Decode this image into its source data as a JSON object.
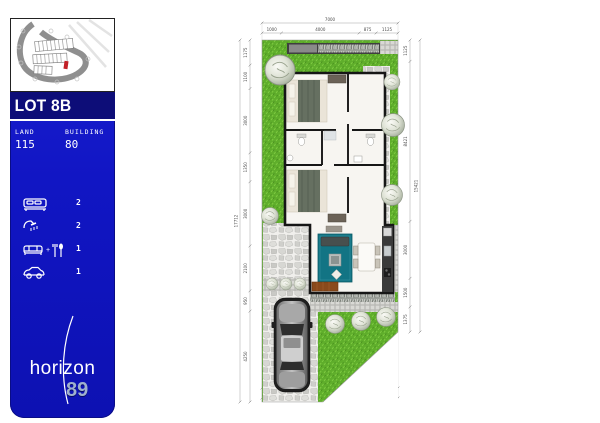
{
  "sidebar": {
    "lot_label": "LOT 8B",
    "land_label": "LAND",
    "land_value": "115",
    "building_label": "BUILDING",
    "building_value": "80",
    "amenities": [
      {
        "name": "bedrooms",
        "icon": "bed-icon",
        "count": "2"
      },
      {
        "name": "bathrooms",
        "icon": "shower-icon",
        "count": "2"
      },
      {
        "name": "living-dining",
        "icon": "sofa-dining-icon",
        "count": "1"
      },
      {
        "name": "carport",
        "icon": "car-icon",
        "count": "1"
      }
    ],
    "brand": {
      "name": "horizon",
      "number": "89"
    },
    "colors": {
      "panel_blue": "#1116c4",
      "band_navy": "#0d0d78",
      "marker_red": "#c32128"
    }
  },
  "plan": {
    "dims": {
      "top_total": "7000",
      "top": [
        "1000",
        "4000",
        "875",
        "1125"
      ],
      "bottom": [
        "1000",
        "2000",
        "1375",
        "1950",
        "675"
      ],
      "bottom_total": "7000",
      "left": [
        "1175",
        "1100",
        "3000",
        "1350",
        "3000",
        "2100",
        "950",
        "4250"
      ],
      "left_total": "17712",
      "right": [
        "1125",
        "8421",
        "3000",
        "1500",
        "1375"
      ],
      "right_total": "15421"
    },
    "colors": {
      "lawn": "#5fae2b",
      "rug_teal": "#127484",
      "bench_wood": "#8a4a1c",
      "wall": "#161616"
    }
  }
}
